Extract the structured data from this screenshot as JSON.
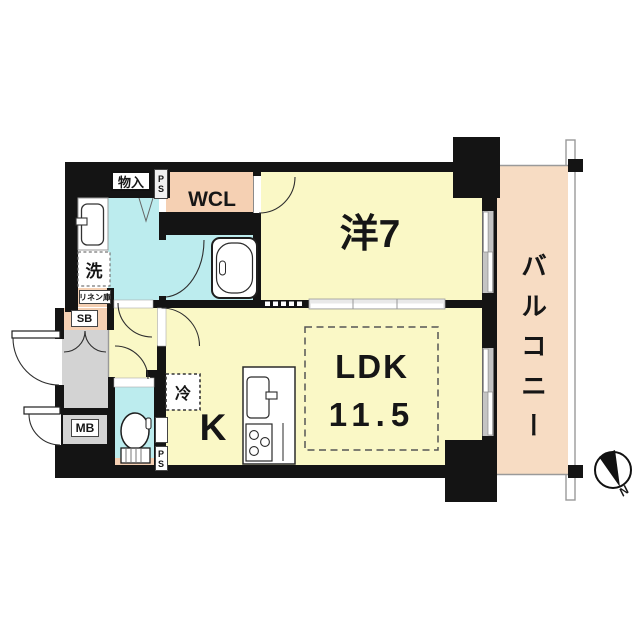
{
  "plan": {
    "type": "apartment-floor-plan",
    "rooms": {
      "bedroom": "洋7",
      "ldk": "LDK",
      "ldk_size": "11.5",
      "kitchen": "K",
      "walk_in_closet": "WCL",
      "balcony": "バルコニー",
      "storage": "物入",
      "laundry": "洗",
      "linen": "リネン庫",
      "shoe_box": "SB",
      "meter_box": "MB",
      "pipe_space": "PS",
      "refrigerator": "冷"
    },
    "compass": {
      "north": "N"
    },
    "colors": {
      "wall": "#141414",
      "room_yellow": "#FAF8C6",
      "wet_cyan": "#BCECEE",
      "closet_peach": "#F5D0B3",
      "balcony_peach": "#F7DCC3",
      "entry_gray": "#D3D3D3",
      "window_gray": "#C4C4C4"
    }
  }
}
